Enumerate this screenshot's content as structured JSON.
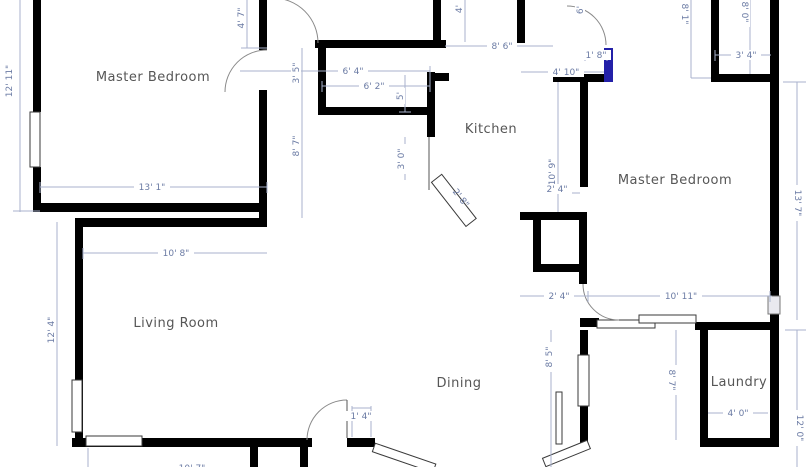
{
  "rooms": {
    "master_bedroom_left": "Master Bedroom",
    "kitchen": "Kitchen",
    "master_bedroom_right": "Master Bedroom",
    "living_room": "Living Room",
    "dining": "Dining",
    "laundry": "Laundry"
  },
  "dimensions": {
    "mb_left_height": "12' 11\"",
    "mb_left_width": "13' 1\"",
    "hall_top_height": "4' 7\"",
    "pantry_width_outer": "6' 4\"",
    "pantry_width_inner": "6' 2\"",
    "hall_upper": "3' 5\"",
    "hall_lower": "8' 7\"",
    "pantry_depth": "5'",
    "kitchen_entry": "3' 0\"",
    "kitchen_door": "2' 8\"",
    "top_mid": "4'",
    "kitchen_top": "8' 6\"",
    "nook_width": "1' 8\"",
    "kitchen_right": "4' 10\"",
    "top_door": "6'",
    "tr_closet_left": "8' 1\"",
    "tr_closet_right": "8' 0\"",
    "tr_closet_width": "3' 4\"",
    "mb_right_height": "13' 7\"",
    "mb_right_wall": "10' 9\"",
    "closet_upper": "2' 4\"",
    "closet_lower": "2' 4\"",
    "mb_right_width": "10' 11\"",
    "living_width": "10' 8\"",
    "living_height": "12' 4\"",
    "dining_door": "1' 4\"",
    "dining_right": "8' 5\"",
    "laundry_height": "8' 7\"",
    "laundry_width": "4' 0\"",
    "right_lower_height": "12' 0\"",
    "bottom_partial": "10' 7\""
  },
  "colors": {
    "wall": "#000000",
    "selected_wall": "#2320a8",
    "dimension_line": "#a8b2cc",
    "dimension_text": "#6b7ba4",
    "room_label": "#565656",
    "background": "#ffffff"
  }
}
